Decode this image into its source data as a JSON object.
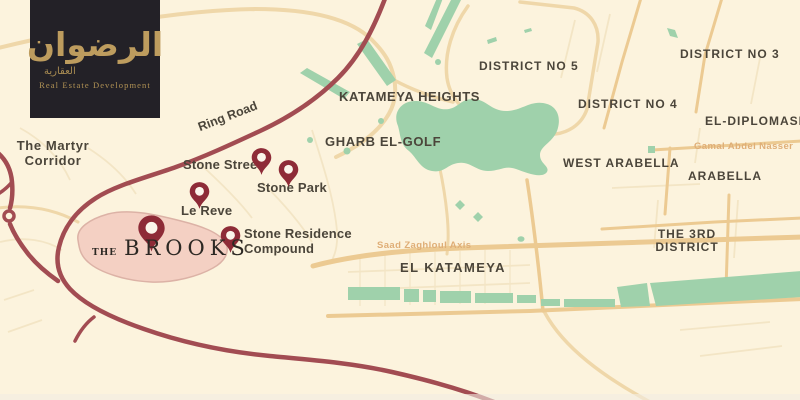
{
  "brand": {
    "arabic_name": "الرضوان",
    "arabic_tagline": "العقارية",
    "tagline": "Real Estate Development"
  },
  "map": {
    "areas": {
      "martyr_corridor": "The Martyr Corridor",
      "katameya_heights": "KATAMEYA HEIGHTS",
      "gharb_el_golf": "GHARB EL-GOLF",
      "district_no_5": "DISTRICT NO 5",
      "district_no_3": "DISTRICT NO 3",
      "district_no_4": "DISTRICT NO 4",
      "el_diplomase": "EL-DIPLOMASE",
      "west_arabella": "WEST ARABELLA",
      "arabella": "ARABELLA",
      "the_3rd_district": "THE 3RD DISTRICT",
      "el_katameya": "EL KATAMEYA"
    },
    "roads": {
      "ring_road": "Ring Road",
      "gamal_abdel_nasser": "Gamal Abdel Nasser",
      "saad_zaghloul_axis": "Saad Zaghloul Axis"
    },
    "pins": {
      "stone_street": "Stone Street",
      "stone_park": "Stone Park",
      "le_reve": "Le Reve",
      "stone_residence": "Stone Residence Compound",
      "brooks_prefix": "THE",
      "brooks_name": "BROOKS"
    },
    "colors": {
      "background": "#fcf3dd",
      "major_road_red": "#a24c52",
      "pin_red": "#8e2b37",
      "green_area": "#9fd1ab",
      "highlight_pink": "#f4d0c3",
      "logo_gold": "#bd9c5e",
      "logo_background": "#232127",
      "orange_road": "#ecca92",
      "label_dark": "#4b453a"
    }
  }
}
